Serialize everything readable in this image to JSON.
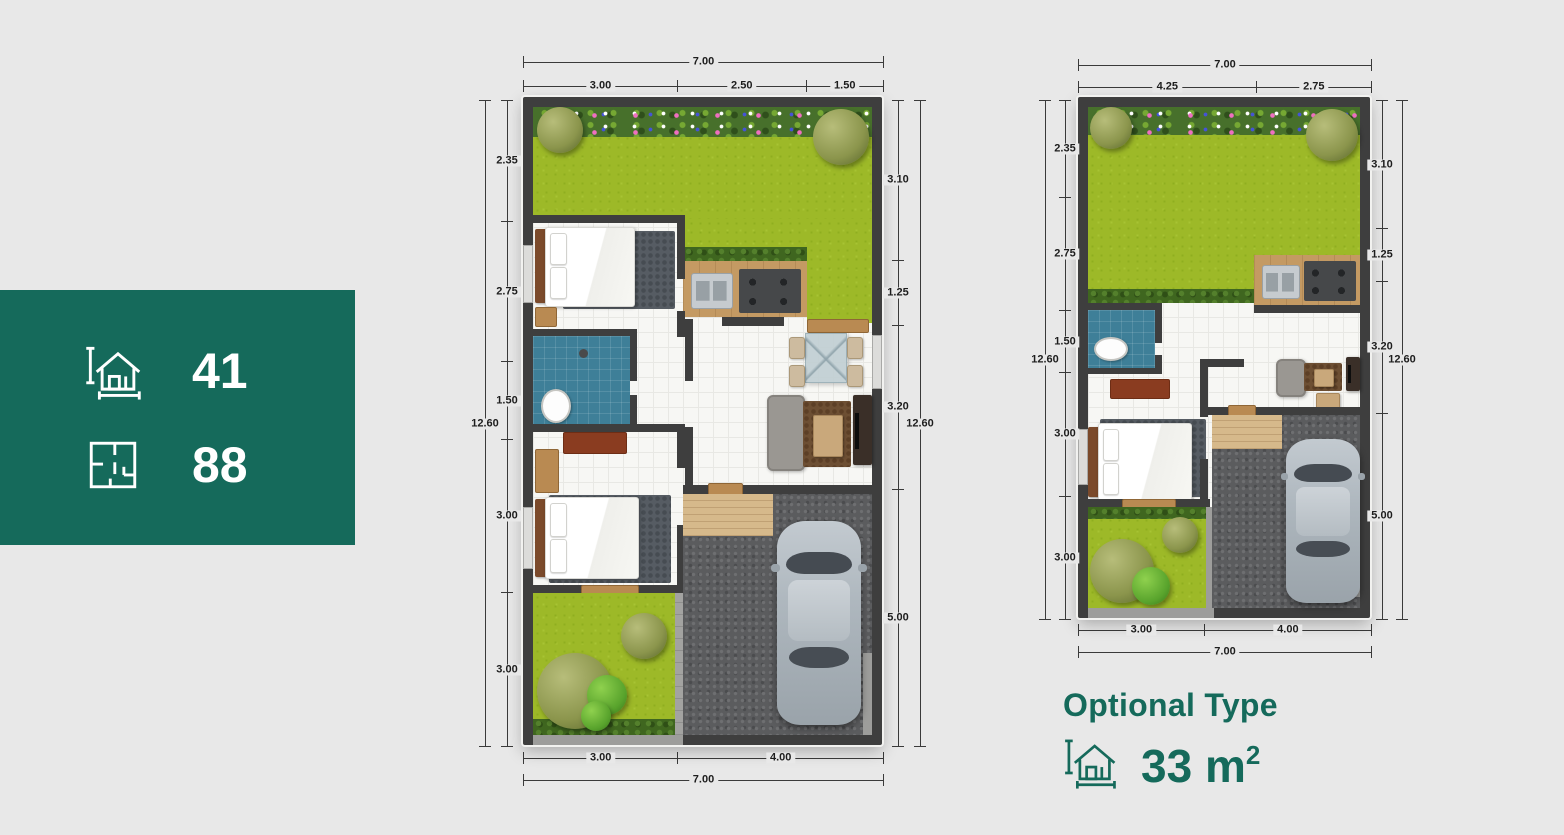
{
  "colors": {
    "accent": "#156a5b",
    "background": "#e8e8e8",
    "wall": "#3e3e3e"
  },
  "badge": {
    "items": [
      {
        "icon": "house-measure-icon",
        "value": "41"
      },
      {
        "icon": "floor-plan-icon",
        "value": "88"
      }
    ]
  },
  "plans": {
    "large": {
      "top_total": [
        "7.00"
      ],
      "top_segments": [
        "3.00",
        "2.50",
        "1.50"
      ],
      "bottom_segments": [
        "3.00",
        "4.00"
      ],
      "bottom_total": [
        "7.00"
      ],
      "left_segments": [
        "2.35",
        "2.75",
        "1.50",
        "3.00",
        "3.00"
      ],
      "left_total": [
        "12.60"
      ],
      "right_segments": [
        "3.10",
        "1.25",
        "3.20",
        "5.00"
      ],
      "right_total": [
        "12.60"
      ]
    },
    "small": {
      "top_total": [
        "7.00"
      ],
      "top_segments": [
        "4.25",
        "2.75"
      ],
      "bottom_segments": [
        "3.00",
        "4.00"
      ],
      "bottom_total": [
        "7.00"
      ],
      "left_segments": [
        "2.35",
        "2.75",
        "1.50",
        "3.00",
        "3.00"
      ],
      "left_total": [
        "12.60"
      ],
      "right_segments": [
        "3.10",
        "1.25",
        "3.20",
        "5.00"
      ],
      "right_total": [
        "12.60"
      ]
    }
  },
  "optional": {
    "title": "Optional Type",
    "icon": "house-measure-icon",
    "area_value": "33 m",
    "area_sup": "2"
  }
}
